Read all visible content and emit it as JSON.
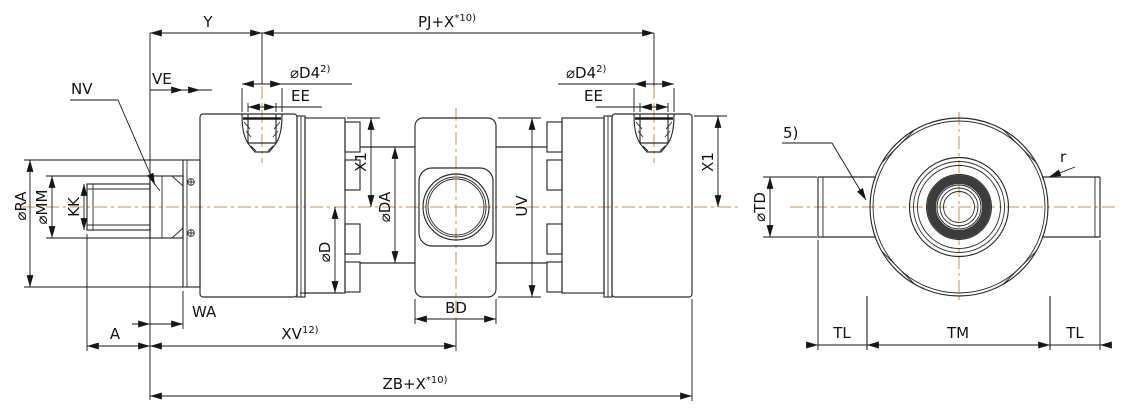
{
  "colors": {
    "line": "#2b2b2b",
    "dimension": "#161616",
    "centerline": "#c5934f",
    "bearing_ring": "#3c3c3c",
    "background": "#ffffff"
  },
  "views": {
    "main": {
      "labels": {
        "y": "Y",
        "pj_base": "PJ+X",
        "pj_sup": "*10)",
        "ve": "VE",
        "nv": "NV",
        "d4l_base": "⌀D4",
        "d4l_sup": "2)",
        "eel": "EE",
        "d4r_base": "⌀D4",
        "d4r_sup": "2)",
        "eer": "EE",
        "x1l": "X1",
        "x1r": "X1",
        "ra": "⌀RA",
        "mm": "⌀MM",
        "kk": "KK",
        "d": "⌀D",
        "da": "⌀DA",
        "uv": "UV",
        "bd": "BD",
        "wa": "WA",
        "a": "A",
        "xv_base": "XV",
        "xv_sup": "12)",
        "zb_base": "ZB+X",
        "zb_sup": "*10)"
      }
    },
    "side": {
      "labels": {
        "note5": "5)",
        "r": "r",
        "td": "⌀TD",
        "tl_left": "TL",
        "tm": "TM",
        "tl_right": "TL"
      }
    }
  }
}
